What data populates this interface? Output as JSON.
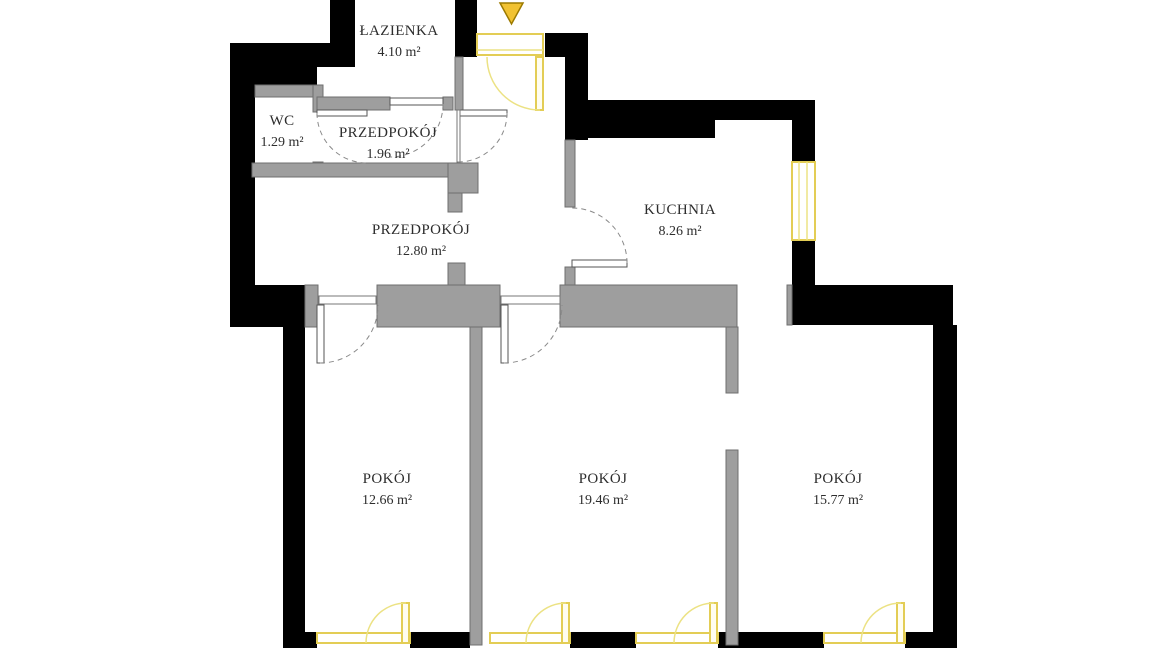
{
  "plan": {
    "type": "apartment-floor-plan",
    "rooms": [
      {
        "id": "lazienka",
        "name": "ŁAZIENKA",
        "area": "4.10 m²"
      },
      {
        "id": "wc",
        "name": "WC",
        "area": "1.29 m²"
      },
      {
        "id": "przedpokoj-1",
        "name": "PRZEDPOKÓJ",
        "area": "1.96 m²"
      },
      {
        "id": "kuchnia",
        "name": "KUCHNIA",
        "area": "8.26 m²"
      },
      {
        "id": "przedpokoj-2",
        "name": "PRZEDPOKÓJ",
        "area": "12.80 m²"
      },
      {
        "id": "pokoj-1",
        "name": "POKÓJ",
        "area": "12.66 m²"
      },
      {
        "id": "pokoj-2",
        "name": "POKÓJ",
        "area": "19.46 m²"
      },
      {
        "id": "pokoj-3",
        "name": "POKÓJ",
        "area": "15.77 m²"
      }
    ],
    "icons": {
      "entrance_marker": "down-triangle-arrow"
    },
    "colors": {
      "background": "#ffffff",
      "wall": "#000000",
      "partition": "#9e9e9e",
      "partition_edge": "#6f6f6f",
      "door_frame": "#e3cd55",
      "door_arc": "#ece284",
      "entrance_marker": "#f1c232",
      "entrance_marker_edge": "#9c7a00",
      "swing_arc": "#8a8a8a",
      "label_text": "#2d2d2d"
    }
  }
}
